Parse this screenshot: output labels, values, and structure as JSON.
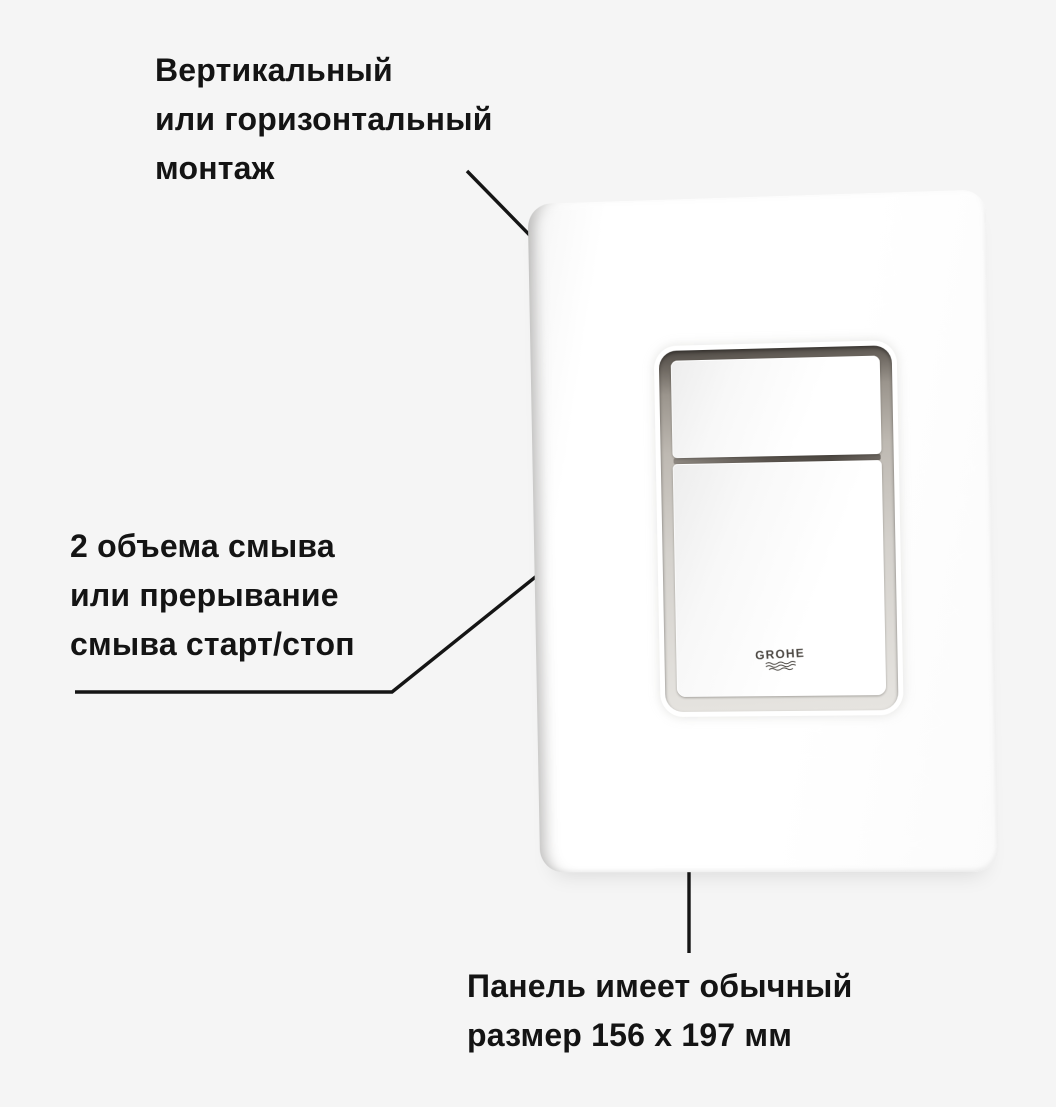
{
  "canvas": {
    "background_color": "#f5f5f5",
    "text_color": "#141414",
    "leader_line_color": "#151515"
  },
  "annotations": {
    "mount": {
      "lines": [
        "Вертикальный",
        "или горизонтальный",
        "монтаж"
      ]
    },
    "flush": {
      "lines": [
        "2 объема смыва",
        "или прерывание",
        "смыва старт/стоп"
      ]
    },
    "size": {
      "lines": [
        "Панель имеет обычный",
        "размер 156 x 197 мм"
      ]
    }
  },
  "product": {
    "brand": "GROHE",
    "panel_color": "#ffffff",
    "recess_shadow_color": "#56514b"
  }
}
